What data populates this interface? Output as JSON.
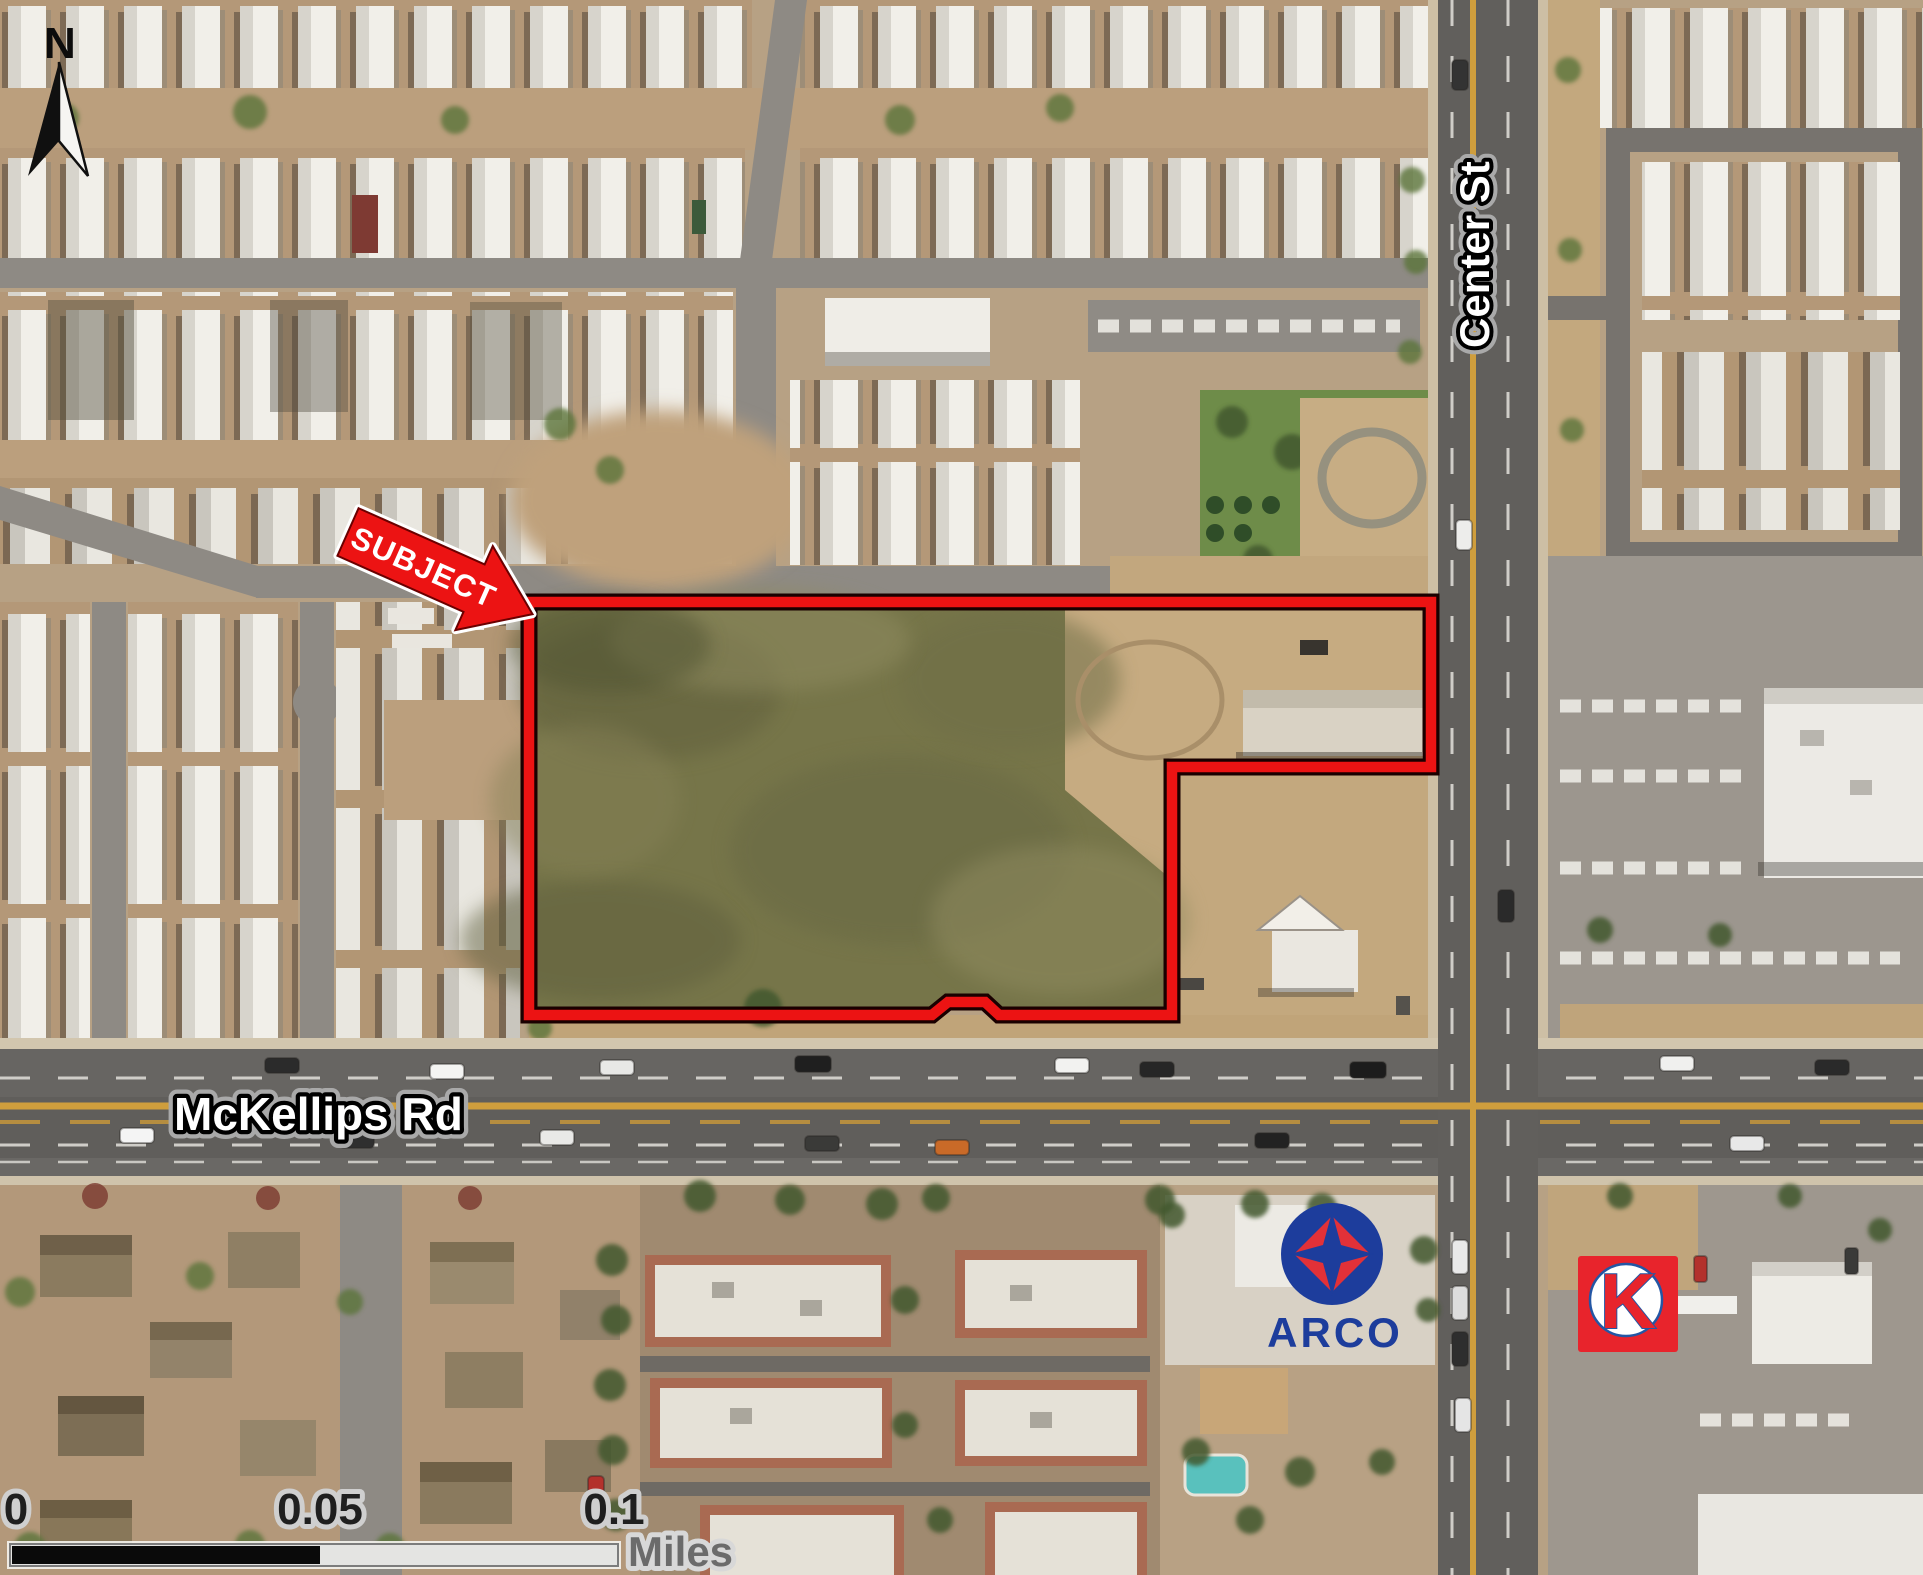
{
  "compass": {
    "north_label": "N"
  },
  "annotations": {
    "subject_label": "SUBJECT"
  },
  "streets": {
    "vertical_label": "Center St",
    "horizontal_label": "McKellips Rd"
  },
  "scale_bar": {
    "ticks": [
      "0",
      "0.05",
      "0.1"
    ],
    "units_label": "Miles"
  },
  "logos": {
    "arco_text": "ARCO",
    "circle_k_letter": "K"
  },
  "colors": {
    "annotation_red": "#ec1313",
    "annotation_outline": "#1a0000",
    "centerline_yellow": "#cf9e3d",
    "arco_blue": "#1d3d9c",
    "arco_red": "#e23138",
    "circlek_red": "#e8242c",
    "circlek_blue": "#2456a4",
    "parcel_grass": "#767549",
    "scale_black": "#0a0a0a"
  }
}
